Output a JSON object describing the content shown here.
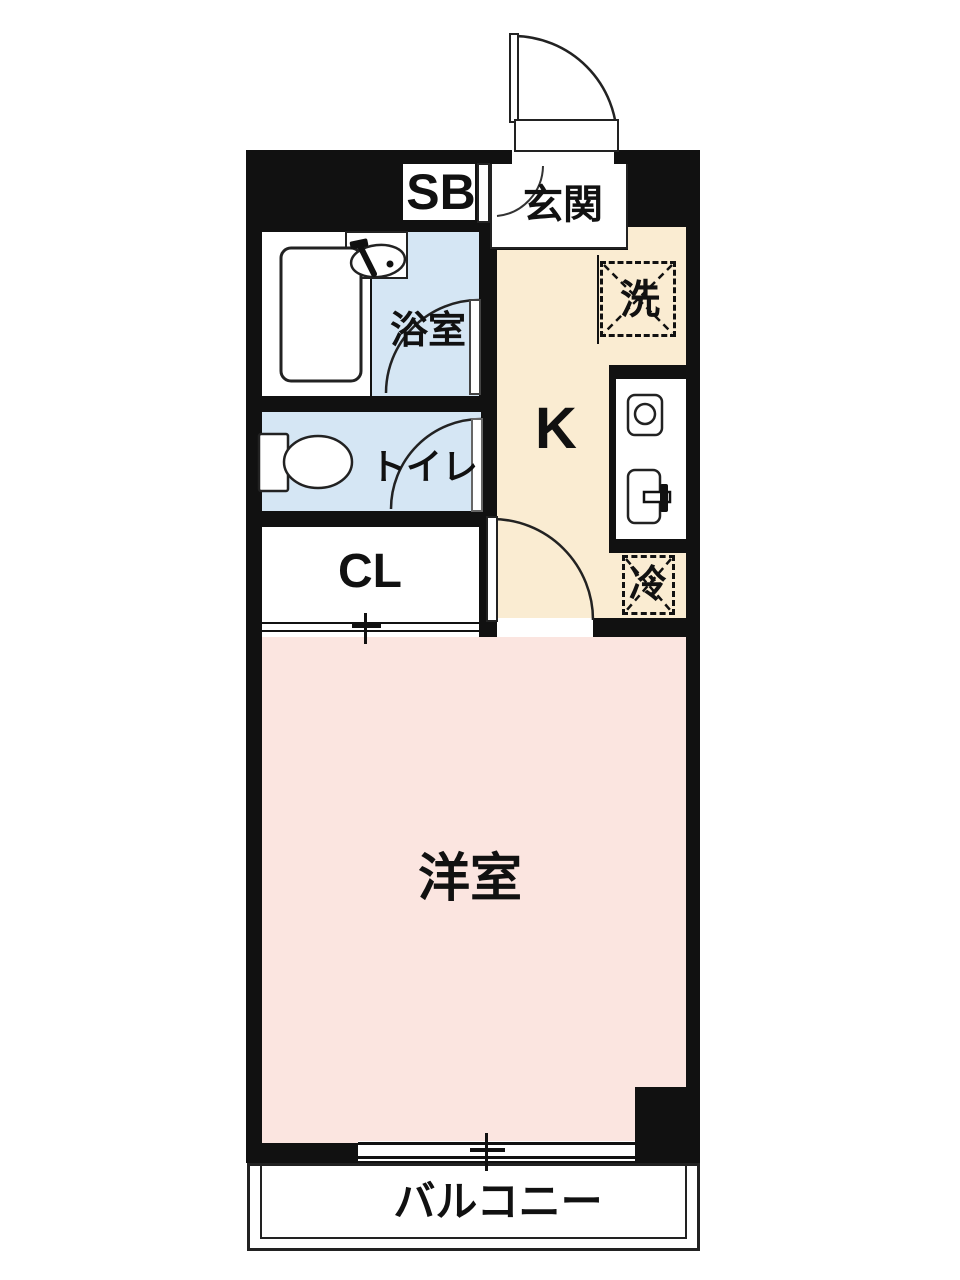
{
  "floorplan": {
    "labels": {
      "shoe_box": "SB",
      "entrance": "玄関",
      "bathroom": "浴室",
      "toilet": "トイレ",
      "closet": "CL",
      "kitchen": "K",
      "washer": "洗",
      "fridge": "冷",
      "western_room": "洋室",
      "balcony": "バルコニー"
    },
    "colors": {
      "wall": "#111111",
      "line": "#222222",
      "water": "#d5e6f4",
      "kitchen": "#faecd2",
      "room": "#fbe5e0",
      "floor": "#ffffff"
    }
  }
}
